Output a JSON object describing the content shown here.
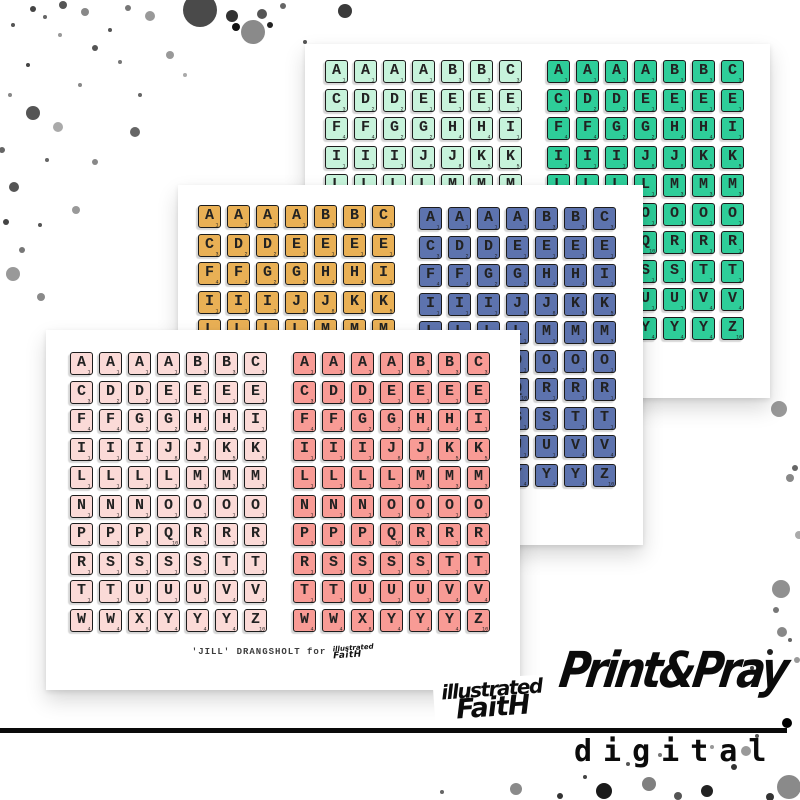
{
  "branding": {
    "print_pray": "Print&Pray",
    "digital": "digital",
    "if_line1": "illustrated",
    "if_line2": "FaitH",
    "credit": "'JILL' DRANGSHOLT for",
    "credit_logo_line1": "illustrated",
    "credit_logo_line2": "FaitH"
  },
  "tiles": {
    "rows": [
      "AAAABBC",
      "CDDEEEE",
      "FFGGHHI",
      "IIIJJKK",
      "LLLLMMM",
      "NNNOOOO",
      "PPPQRRR",
      "RSSSSTT",
      "TTUUUVV",
      "WWXYYYZ"
    ],
    "points": {
      "A": 1,
      "B": 3,
      "C": 3,
      "D": 2,
      "E": 1,
      "F": 4,
      "G": 2,
      "H": 4,
      "I": 1,
      "J": 8,
      "K": 5,
      "L": 1,
      "M": 3,
      "N": 1,
      "O": 1,
      "P": 3,
      "Q": 10,
      "R": 1,
      "S": 1,
      "T": 1,
      "U": 1,
      "V": 4,
      "W": 4,
      "X": 8,
      "Y": 4,
      "Z": 10
    }
  },
  "sheets": [
    {
      "name": "back-sheet",
      "grids": [
        {
          "color_name": "mint",
          "color": "#c7f3db"
        },
        {
          "color_name": "teal",
          "color": "#2ecd99"
        }
      ]
    },
    {
      "name": "middle-sheet",
      "grids": [
        {
          "color_name": "gold",
          "color": "#e9b055"
        },
        {
          "color_name": "blue",
          "color": "#5d73ae"
        }
      ]
    },
    {
      "name": "front-sheet",
      "grids": [
        {
          "color_name": "light-pink",
          "color": "#fbdad7"
        },
        {
          "color_name": "coral",
          "color": "#f89b95"
        }
      ]
    }
  ],
  "decor": {
    "ink_color": "#111111",
    "splatters": [
      [
        200,
        10,
        17,
        "#4a4a4a"
      ],
      [
        232,
        16,
        6,
        "#333333"
      ],
      [
        236,
        27,
        4,
        "#111111"
      ],
      [
        253,
        32,
        12,
        "#8a8a8a"
      ],
      [
        262,
        14,
        5,
        "#555555"
      ],
      [
        270,
        25,
        3,
        "#222222"
      ],
      [
        283,
        6,
        3,
        "#666666"
      ],
      [
        345,
        11,
        7,
        "#3a3a3a"
      ],
      [
        305,
        42,
        2,
        "#555555"
      ],
      [
        150,
        16,
        5,
        "#999999"
      ],
      [
        128,
        8,
        3,
        "#777777"
      ],
      [
        85,
        12,
        4,
        "#888888"
      ],
      [
        63,
        5,
        4,
        "#555555"
      ],
      [
        33,
        9,
        3,
        "#444444"
      ],
      [
        45,
        17,
        2,
        "#666666"
      ],
      [
        13,
        25,
        2,
        "#555555"
      ],
      [
        95,
        48,
        3,
        "#555555"
      ],
      [
        120,
        62,
        2,
        "#777777"
      ],
      [
        170,
        55,
        4,
        "#999999"
      ],
      [
        140,
        95,
        2,
        "#666666"
      ],
      [
        135,
        132,
        5,
        "#666666"
      ],
      [
        58,
        127,
        5,
        "#aaaaaa"
      ],
      [
        33,
        113,
        7,
        "#555555"
      ],
      [
        80,
        85,
        2,
        "#888888"
      ],
      [
        95,
        162,
        3,
        "#888888"
      ],
      [
        47,
        160,
        2,
        "#666666"
      ],
      [
        14,
        187,
        5,
        "#555555"
      ],
      [
        6,
        222,
        3,
        "#444444"
      ],
      [
        22,
        250,
        3,
        "#777777"
      ],
      [
        13,
        274,
        7,
        "#999999"
      ],
      [
        76,
        210,
        4,
        "#999999"
      ],
      [
        40,
        225,
        2,
        "#555555"
      ],
      [
        2,
        150,
        3,
        "#666666"
      ],
      [
        28,
        65,
        2,
        "#444444"
      ],
      [
        10,
        95,
        2,
        "#888888"
      ],
      [
        60,
        35,
        2,
        "#999999"
      ],
      [
        185,
        75,
        2,
        "#aaaaaa"
      ],
      [
        110,
        30,
        2,
        "#555555"
      ],
      [
        41,
        297,
        4,
        "#8a8a8a"
      ],
      [
        779,
        409,
        8,
        "#999999"
      ],
      [
        795,
        468,
        3,
        "#666666"
      ],
      [
        790,
        478,
        4,
        "#888888"
      ],
      [
        799,
        535,
        4,
        "#aaaaaa"
      ],
      [
        781,
        589,
        9,
        "#909090"
      ],
      [
        776,
        610,
        3,
        "#777777"
      ],
      [
        782,
        632,
        5,
        "#888888"
      ],
      [
        797,
        660,
        3,
        "#999999"
      ],
      [
        516,
        789,
        6,
        "#8a8a8a"
      ],
      [
        560,
        796,
        3,
        "#333333"
      ],
      [
        585,
        777,
        2,
        "#444444"
      ],
      [
        604,
        791,
        8,
        "#1a1a1a"
      ],
      [
        628,
        764,
        2,
        "#555555"
      ],
      [
        649,
        784,
        7,
        "#808080"
      ],
      [
        678,
        796,
        4,
        "#555555"
      ],
      [
        707,
        791,
        6,
        "#222222"
      ],
      [
        734,
        767,
        3,
        "#333333"
      ],
      [
        746,
        751,
        5,
        "#999999"
      ],
      [
        789,
        787,
        12,
        "#8a8a8a"
      ],
      [
        770,
        797,
        4,
        "#333333"
      ],
      [
        757,
        736,
        2,
        "#555555"
      ],
      [
        712,
        747,
        2,
        "#999999"
      ],
      [
        660,
        755,
        2,
        "#777777"
      ],
      [
        442,
        792,
        2,
        "#666666"
      ],
      [
        770,
        652,
        3,
        "#222222"
      ],
      [
        752,
        668,
        2,
        "#444444"
      ],
      [
        790,
        640,
        2,
        "#666666"
      ],
      [
        787,
        723,
        5,
        "#000000"
      ]
    ]
  }
}
